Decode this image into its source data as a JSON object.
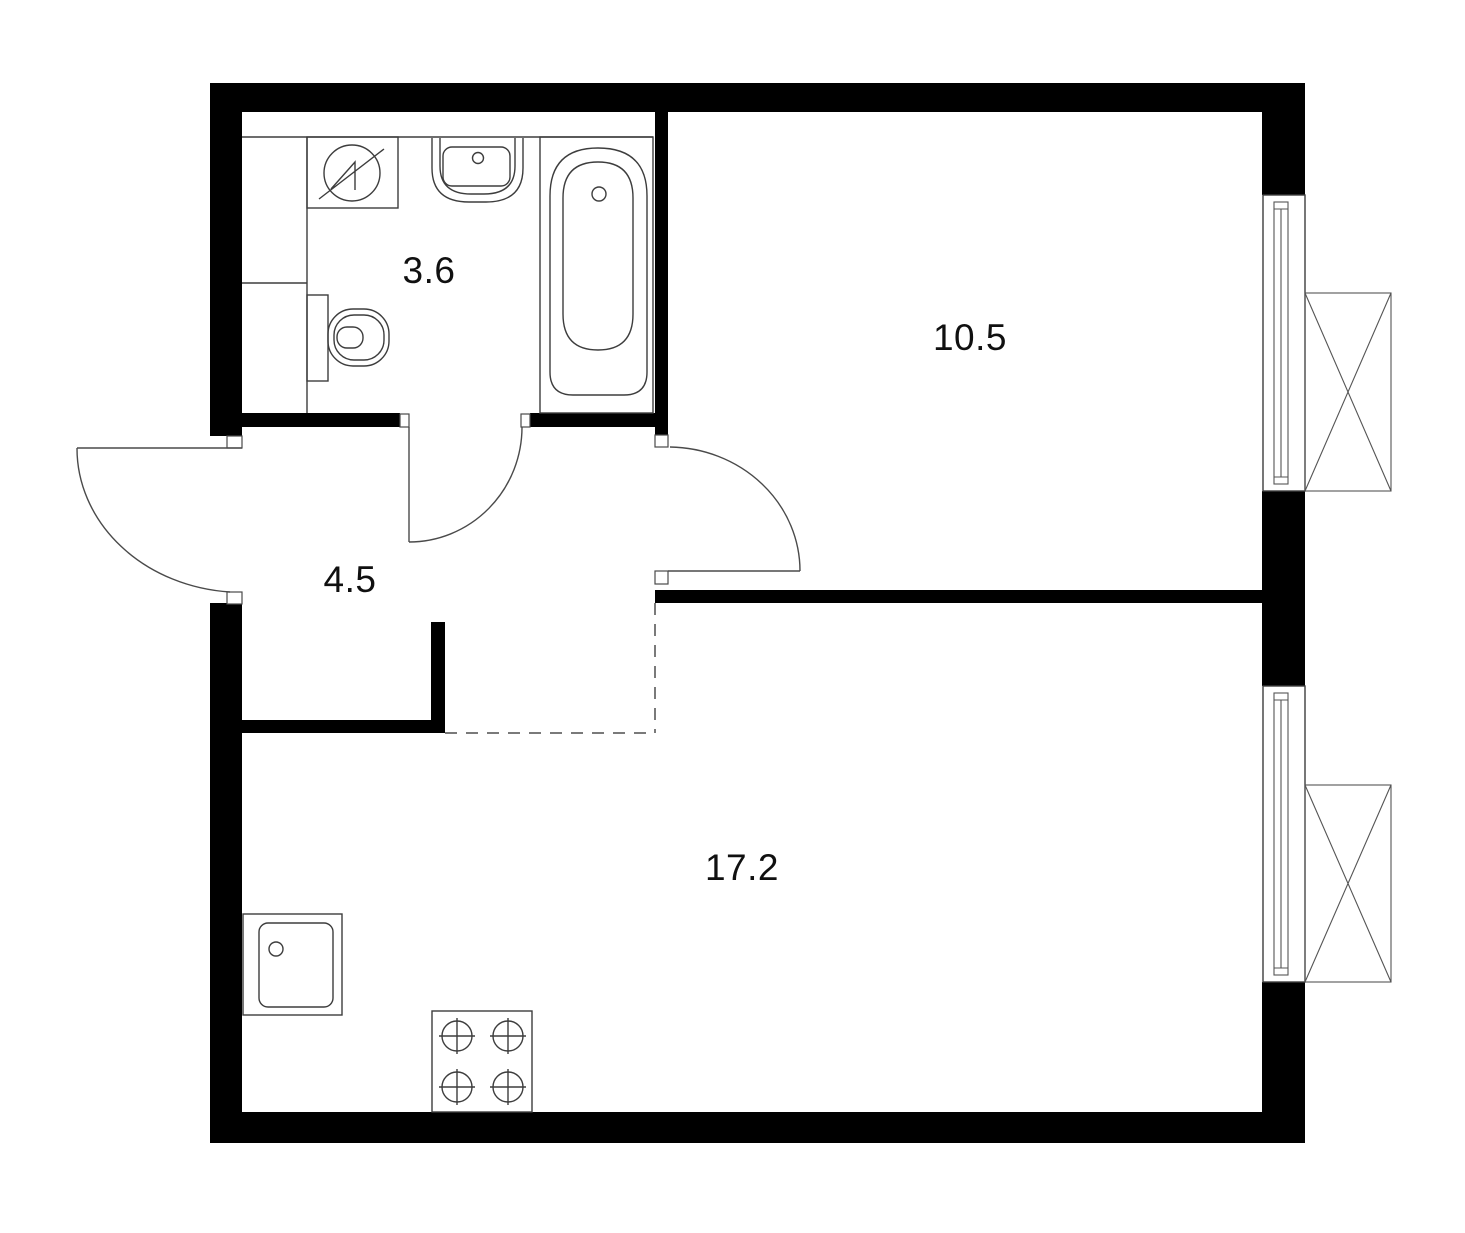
{
  "title": "apartment-floor-plan",
  "rooms": [
    {
      "name": "bathroom",
      "area": "3.6"
    },
    {
      "name": "bedroom",
      "area": "10.5"
    },
    {
      "name": "hallway",
      "area": "4.5"
    },
    {
      "name": "kitchen-living-room",
      "area": "17.2"
    }
  ],
  "fixtures": [
    {
      "name": "washing-machine"
    },
    {
      "name": "wash-basin"
    },
    {
      "name": "bathtub"
    },
    {
      "name": "toilet"
    },
    {
      "name": "ventilation-shaft"
    },
    {
      "name": "kitchen-sink"
    },
    {
      "name": "stove-4-burners"
    },
    {
      "name": "window-top"
    },
    {
      "name": "window-bottom"
    },
    {
      "name": "ac-unit-basket-top"
    },
    {
      "name": "ac-unit-basket-bottom"
    }
  ],
  "doors": [
    {
      "name": "entry-door"
    },
    {
      "name": "bathroom-door"
    },
    {
      "name": "bedroom-door"
    }
  ],
  "colors": {
    "wall": "#000000",
    "fixture_line": "#3d3d3d",
    "dashed_line": "#7a7a7a",
    "background": "#ffffff",
    "label_text": "#101010"
  }
}
